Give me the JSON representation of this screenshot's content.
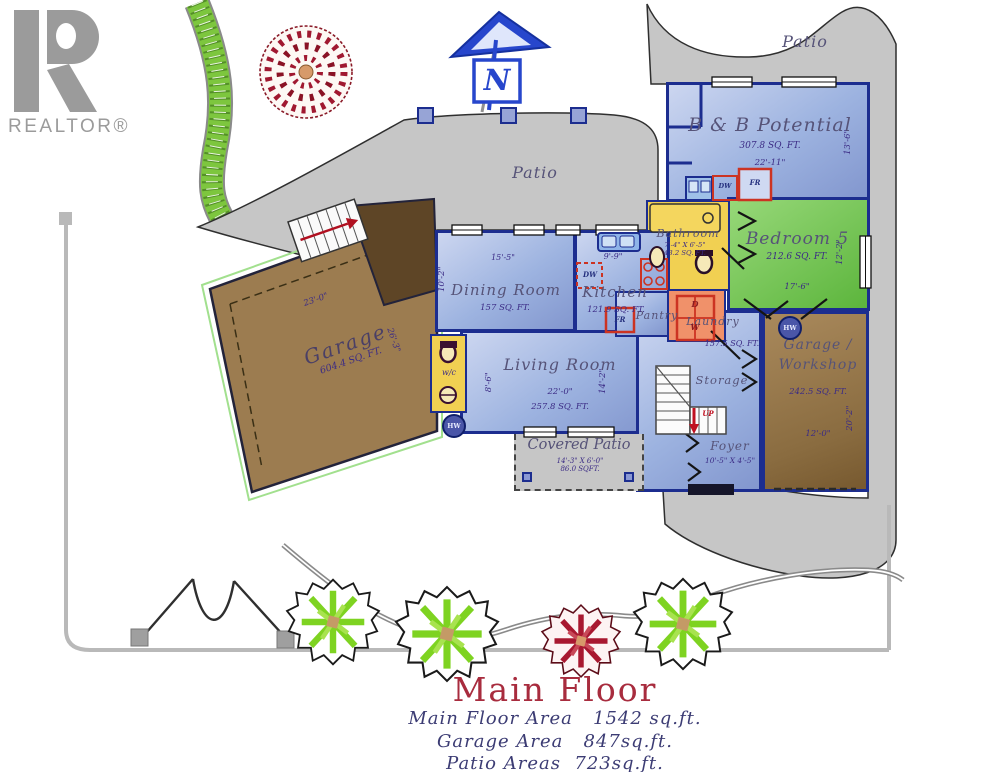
{
  "branding": {
    "logo_text": "REALTOR®"
  },
  "compass": {
    "label": "N"
  },
  "site": {
    "patio_top": "Patio",
    "patio_central": "Patio"
  },
  "rooms": {
    "bnb": {
      "name": "B & B Potential",
      "area": "307.8 SQ. FT.",
      "width": "22'-11\"",
      "depth": "13'-6\""
    },
    "bedroom5": {
      "name": "Bedroom 5",
      "area": "212.6 SQ. FT.",
      "width": "17'-6\"",
      "depth": "12'-2\""
    },
    "bathroom": {
      "name": "Bathroom",
      "dims": "7'-4\" X 6'-5\"",
      "area": "43.2 SQ. FT."
    },
    "pantry": {
      "name": "Pantry"
    },
    "laundry": {
      "name": "Laundry"
    },
    "kitchen": {
      "name": "Kitchen",
      "area": "121.9 SQ. FT.",
      "counter_width": "9'-9\""
    },
    "dining": {
      "name": "Dining Room",
      "area": "157 SQ. FT.",
      "width": "15'-5\"",
      "depth": "10'-2\""
    },
    "living": {
      "name": "Living Room",
      "width": "22'-0\"",
      "area": "257.8 SQ. FT.",
      "left_dim": "8'-6\"",
      "right_dim": "14'-2\""
    },
    "wc": {
      "name": "w/c"
    },
    "hall": {
      "area": "157.5 SQ. FT."
    },
    "storage": {
      "name": "Storage"
    },
    "foyer": {
      "name": "Foyer",
      "dims": "10'-5\" X 4'-5\""
    },
    "workshop": {
      "line1": "Garage /",
      "line2": "Workshop",
      "area": "242.5 SQ. FT.",
      "width": "12'-0\"",
      "depth": "20'-2\""
    },
    "garage": {
      "name": "Garage",
      "area": "604.4 SQ. FT.",
      "width": "23'-0\"",
      "depth": "26'-3\""
    },
    "covered_patio": {
      "name": "Covered Patio",
      "dims": "14'-3\" X 6'-0\"",
      "area": "86.0 SQFT."
    }
  },
  "fixtures": {
    "hw": "HW",
    "up": "UP",
    "dw": "DW",
    "fr": "FR",
    "dryer": "D",
    "washer": "W"
  },
  "title_block": {
    "title": "Main Floor",
    "area_lines": [
      "Main Floor Area   1542 sq.ft.",
      "Garage Area   847sq.ft.",
      "Patio Areas  723sq.ft."
    ]
  },
  "colors": {
    "room_blue": "#9db3e0",
    "room_green": "#6cc24a",
    "room_yellow": "#f1d052",
    "room_orange": "#f0916a",
    "room_brown": "#9b7b50",
    "patio_gray": "#c6c6c6",
    "wall_navy": "#1c2d8f",
    "title_red": "#a82c3e",
    "text_purple": "#3b2b85",
    "compass_blue": "#2746cc",
    "realtor_gray": "#9b9b9b",
    "tree_green": "#7ed321",
    "tree_red": "#a81830"
  }
}
